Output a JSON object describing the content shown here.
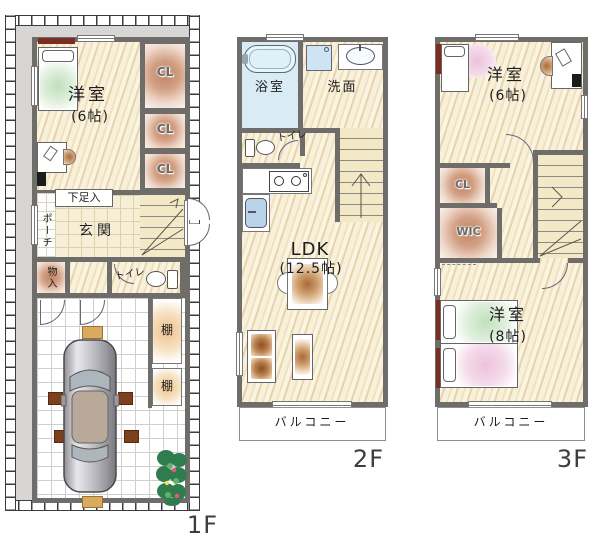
{
  "plan_title": "3-story house floor plan",
  "colors": {
    "wall": "#6e6d69",
    "yard": "#d7d6d4",
    "wood_floor": "#f3ead0",
    "closet_gradient": "#bd8465",
    "bath_floor": "#d9ebf4",
    "stairs": "#f4e9c6",
    "accent_red": "#7c2d22"
  },
  "floors": {
    "f1": {
      "label": "1F",
      "rooms": {
        "yoshitsu": "洋室",
        "yoshitsu_size": "(6帖)",
        "cl1": "CL",
        "cl2": "CL",
        "cl3": "CL",
        "shoe_cabinet": "下足入",
        "porch": "ポーチ",
        "entrance": "玄関",
        "storage": "物入",
        "toilet": "トイレ",
        "shelf_top": "棚",
        "shelf_bottom": "棚"
      }
    },
    "f2": {
      "label": "2F",
      "rooms": {
        "bathroom": "浴室",
        "washroom": "洗面",
        "toilet": "トイレ",
        "ldk": "LDK",
        "ldk_size": "(12.5帖)",
        "balcony": "バルコニー"
      }
    },
    "f3": {
      "label": "3F",
      "rooms": {
        "bedroom6": "洋室",
        "bedroom6_size": "(6帖)",
        "cl": "CL",
        "wic": "WIC",
        "bedroom8": "洋室",
        "bedroom8_size": "(8帖)",
        "balcony": "バルコニー"
      }
    }
  }
}
